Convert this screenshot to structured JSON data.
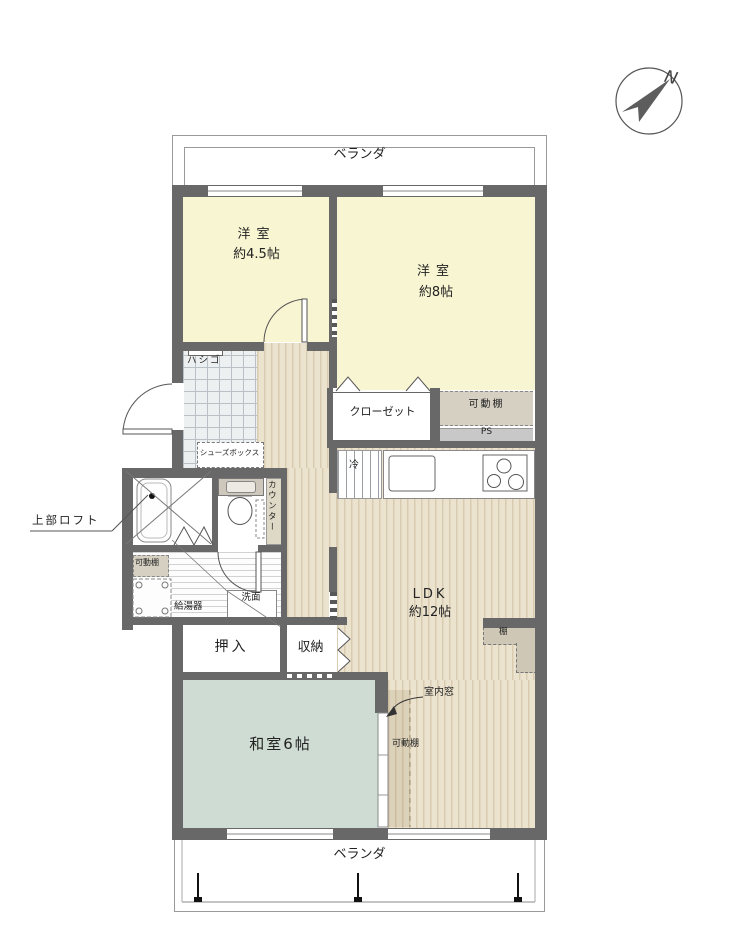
{
  "balcony_top": {
    "label": "ベランダ"
  },
  "balcony_bottom": {
    "label": "ベランダ"
  },
  "compass": {
    "north": "N"
  },
  "rooms": {
    "bedroom_small": {
      "name": "洋室",
      "size": "約4.5帖"
    },
    "bedroom_large": {
      "name": "洋室",
      "size": "約8帖"
    },
    "ldk": {
      "name": "LDK",
      "size": "約12帖"
    },
    "japanese_room": {
      "name": "和室6帖"
    },
    "closet": {
      "name": "クローゼット"
    },
    "futon_closet": {
      "name": "押入"
    },
    "storage": {
      "name": "収納"
    }
  },
  "features": {
    "ladder": "ハシゴ",
    "shoe_box": "シューズボックス",
    "movable_shelf_bedroom": "可動棚",
    "movable_shelf_washroom": "可動棚",
    "movable_shelf_ldk": "可動棚",
    "pipe_space": "PS",
    "counter": "カウンター",
    "upper_loft": "上部ロフト",
    "water_heater": "給湯器",
    "washbasin": "洗面",
    "indoor_window": "室内窓",
    "refrigerator": "冷",
    "shelf": "棚"
  },
  "colors": {
    "wall": "#686868",
    "bedroom_floor": "#f8f5d2",
    "japanese_room_floor": "#cfdcd3",
    "wood_floor": "#ece3cf",
    "shelf_fill": "#d6d0c2"
  }
}
